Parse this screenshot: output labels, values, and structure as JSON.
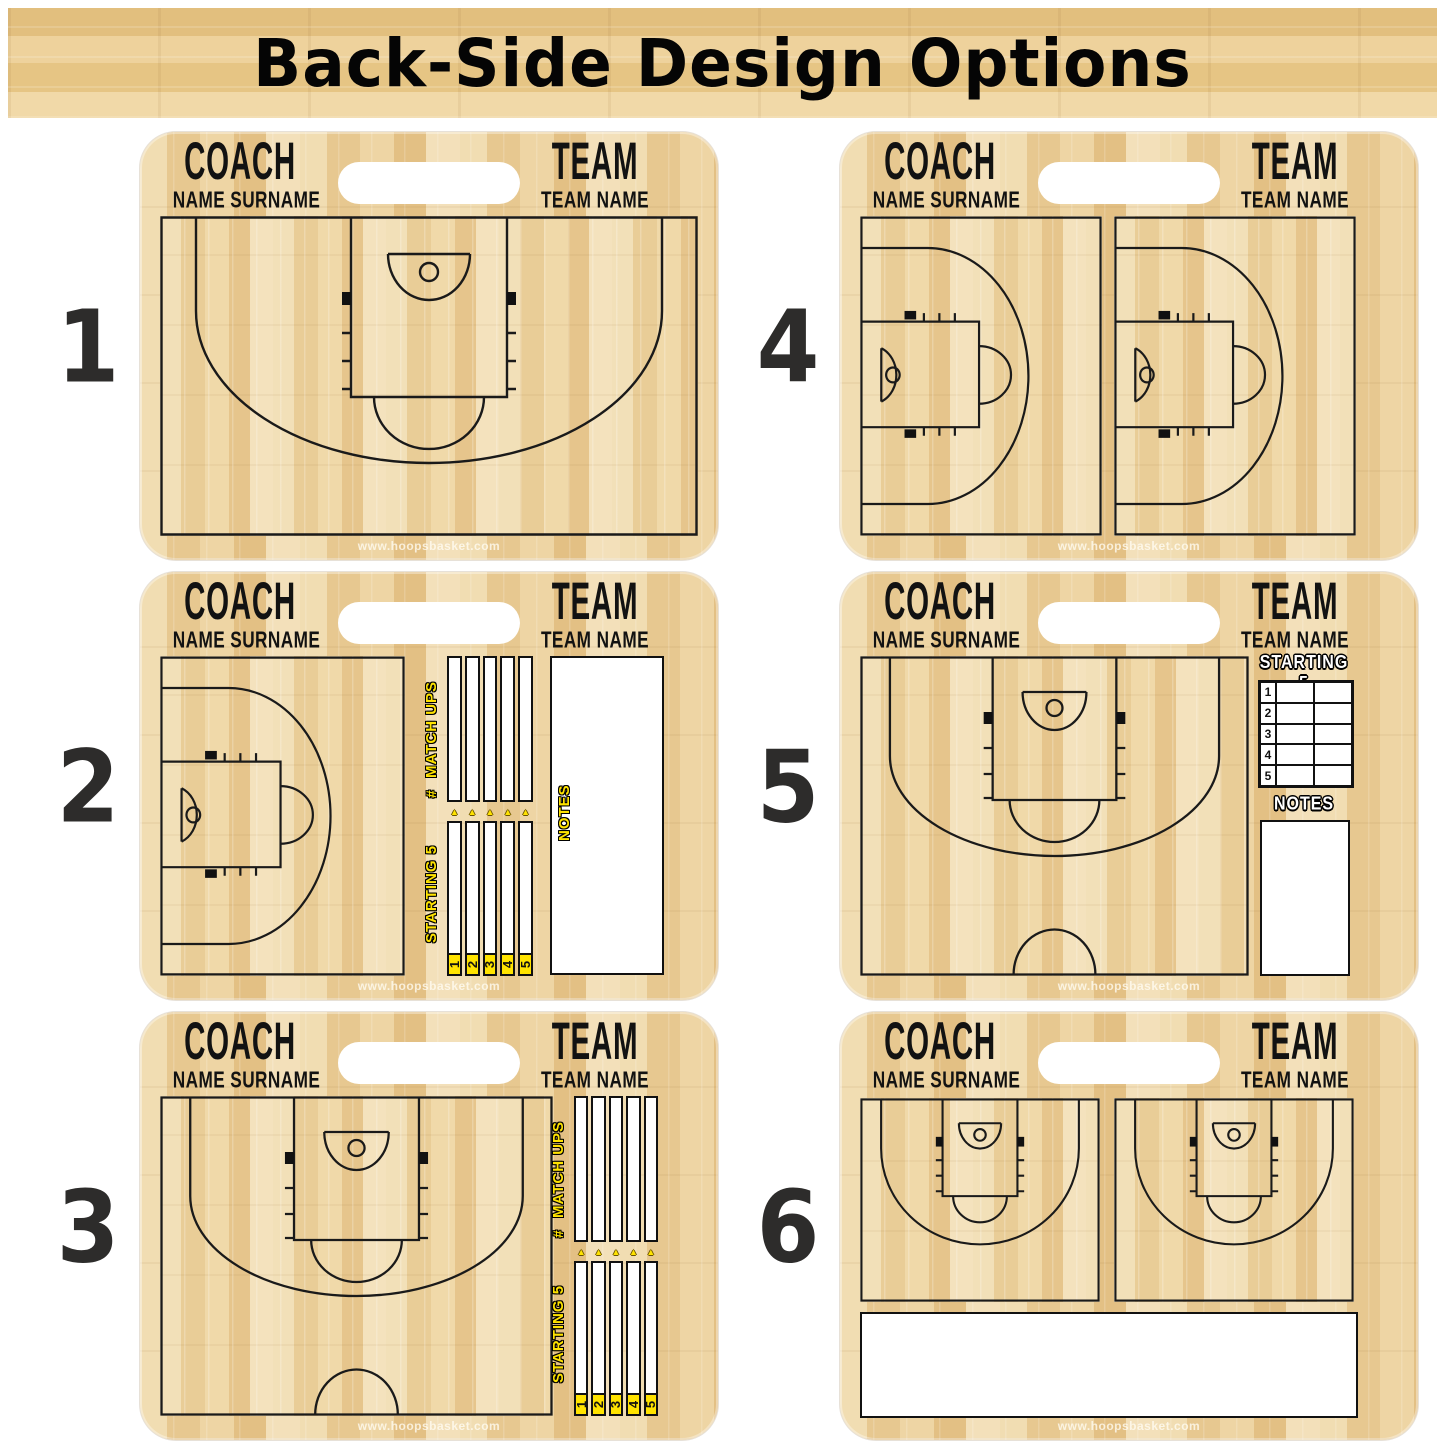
{
  "page": {
    "title": "Back-Side Design Options",
    "watermark": "www.hoopsbasket.com"
  },
  "colors": {
    "accent_yellow": "#FFE300",
    "court_line": "#1a1a1a",
    "number_color": "#2d2c2b",
    "wood_base": "#ecd3a1"
  },
  "labels": {
    "coach": "COACH",
    "coach_name": "NAME SURNAME",
    "team": "TEAM",
    "team_name": "TEAM NAME",
    "matchups": "MATCH UPS",
    "number_sign": "#",
    "starting5": "STARTING 5",
    "notes": "NOTES"
  },
  "starters": [
    "1",
    "2",
    "3",
    "4",
    "5"
  ],
  "boards": [
    {
      "number": "1"
    },
    {
      "number": "2"
    },
    {
      "number": "3"
    },
    {
      "number": "4"
    },
    {
      "number": "5"
    },
    {
      "number": "6"
    }
  ]
}
